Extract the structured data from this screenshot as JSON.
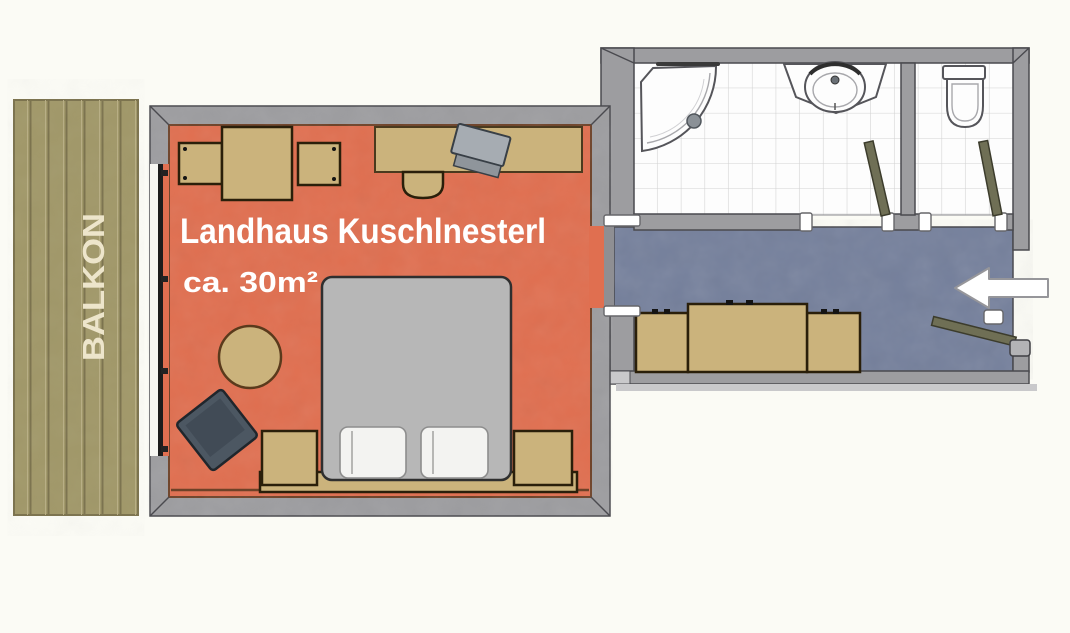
{
  "labels": {
    "room": "Landhaus Kuschlnesterl",
    "area": "ca. 30m²",
    "balcony": "BALKON"
  },
  "icons": [
    "entrance-arrow-icon",
    "shower-icon",
    "washbasin-icon",
    "toilet-icon",
    "double-bed-icon",
    "pillow-icon",
    "wardrobe-icon",
    "dining-table-icon",
    "chair-icon",
    "desk-icon",
    "tv-icon",
    "armchair-icon",
    "side-table-icon",
    "nightstand-icon",
    "door-leaf-icon",
    "sliding-door-icon"
  ],
  "colors": {
    "background": "#fbfbf5",
    "balcony": "#a19869",
    "balcony_line": "#7b724d",
    "balcony_text": "#ede5cb",
    "room_floor": "#e06f50",
    "room_floor_edge": "#6e4228",
    "hall_floor": "#75809c",
    "wall": "#9d9da0",
    "wall_stroke": "#4a4a4f",
    "tile_grout": "#d2d2d2",
    "fixture_white": "#fdfdfd",
    "fixture_stroke": "#55555a",
    "furniture_tan": "#cbb37c",
    "furniture_outline": "#2a1f0a",
    "desk_outline": "#4a3a1e",
    "bed_gray": "#b7b7b7",
    "bed_stroke": "#2f2f2f",
    "pillow": "#f3f3f1",
    "pillow_stroke": "#8d8d8d",
    "armchair": "#4c5762",
    "armchair_stroke": "#20262c",
    "door_leaf": "#6f6f55",
    "tv_gray": "#a6acb2",
    "arrow_fill": "#ffffff",
    "arrow_stroke": "#96969a",
    "label_white": "#ffffff"
  }
}
